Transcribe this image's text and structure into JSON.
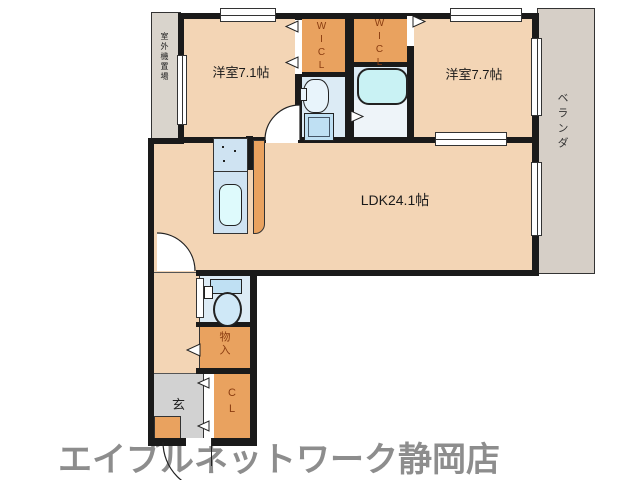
{
  "page": {
    "type": "real-estate-floor-plan"
  },
  "rooms": {
    "bedroom1": {
      "label": "洋室7.1帖"
    },
    "bedroom2": {
      "label": "洋室7.7帖"
    },
    "ldk": {
      "label": "LDK24.1帖"
    },
    "wic1": {
      "label": "WICL"
    },
    "wic2": {
      "label": "WICL"
    },
    "closet": {
      "label": "CL"
    },
    "storage": {
      "label": "物入"
    },
    "entry": {
      "label": "玄"
    },
    "veranda": {
      "label": "ベランダ"
    },
    "outdoor_unit": {
      "label": "室外機置場"
    }
  },
  "footer": {
    "brand": "エイブルネットワーク静岡店"
  },
  "icons": {
    "kitchen_sink": "kitchen-sink-icon",
    "kitchen_stove": "kitchen-stove-icon",
    "bathtub": "bathtub-icon",
    "washbasin": "washbasin-icon",
    "washing_machine": "washing-machine-icon",
    "toilet": "toilet-icon",
    "door_arc": "door-swing-arc",
    "door_triangle": "sliding-door-triangle"
  },
  "colors": {
    "room": "#f3d5b5",
    "closet": "#e9a25f",
    "bathroom": "#dcebf5",
    "bath_lower": "#eef4f9",
    "tub": "#c9f2f4",
    "fixture": "#bfe0f3",
    "sink": "#defafc",
    "stove": "#cfe3f2",
    "veranda": "#d6cfc7",
    "service": "#d9d4cc",
    "entry": "#d2d2d2",
    "wall": "#1a1a1a",
    "line": "#333333",
    "label": "#1a1a1a",
    "closet_label": "#8a3c10",
    "brand": "#8d8d8d"
  }
}
